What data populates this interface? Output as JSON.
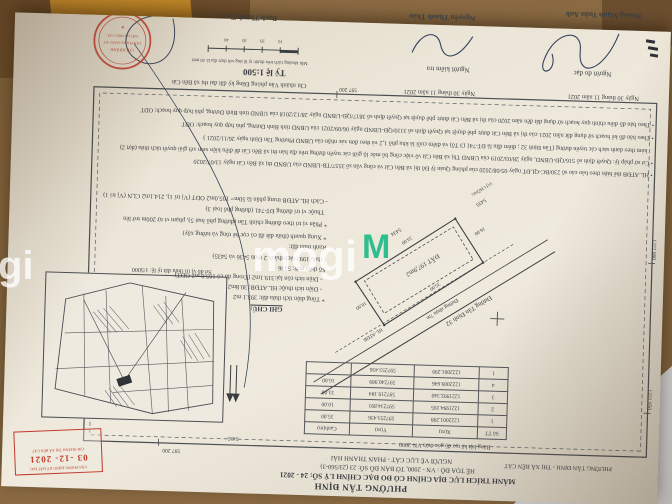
{
  "photo": {
    "background_color": "#8a6a42",
    "watermark": {
      "text": "mogi",
      "m_icon": "M",
      "green": "#2fbf8f"
    }
  },
  "document": {
    "header": {
      "region_line": "PHƯỜNG TÂN ĐỊNH - THỊ XÃ BẾN CÁT",
      "ward": "PHƯỜNG TÂN ĐỊNH",
      "title": "MẢNH TRÍCH LỤC ĐỊA CHÍNH CÓ ĐO ĐẠC CHỈNH LÝ SỐ: 24 - 2021",
      "coord_system": "HỆ TỌA ĐỘ : VN - 2000, TỜ BẢN ĐỒ SỐ: 23 (23/560-3)",
      "drafter": "NGƯỜI VẼ LỤC CÁT - PHAN THANH HẢI"
    },
    "grid_labels": {
      "top": "597 200",
      "bottom": "597 200",
      "left_top": "1221 950",
      "left_mid": "1222 000",
      "parcel_ref": "5435"
    },
    "coord_table": {
      "title": "Bảng liệt kê tọa độ góc thửa VN-2000",
      "columns": [
        "Số TT",
        "X(m)",
        "Y(m)",
        "Cạnh(m)"
      ],
      "rows": [
        [
          "1",
          "1222001.299",
          "597253.436",
          "35.00"
        ],
        [
          "2",
          "1221994.195",
          "597234.891",
          "10.00"
        ],
        [
          "3",
          "1221992.340",
          "597219.184",
          "33.00"
        ],
        [
          "4",
          "1222009.646",
          "597240.989",
          "16.00"
        ],
        [
          "1",
          "1222001.299",
          "597253.436",
          ""
        ]
      ]
    },
    "sketch": {
      "road_name": "Đường Tân Định 32",
      "road_surface": "Đường nhựa 7m",
      "corridor": "HL-ATĐB",
      "parcel_area": "ĐẤT 197,9m2",
      "dim_long_top": "35.00",
      "dim_short_right": "10.00",
      "dim_long_bottom": "33.00",
      "dim_short_left": "16.00",
      "neighbor_bottom": "5434",
      "neighbor_left": "5435",
      "neighbor_owner": "VỢ CHỒNG"
    },
    "inset": {
      "caption": "Sơ đồ vị trí thửa đất tỷ lệ: 1/5000"
    },
    "date_stamp": {
      "line1": "VĂN PHÒNG ĐĂNG KÝ ĐẤT ĐAI",
      "date": "03 -12- 2021",
      "line2": "CHI NHÁNH THỊ XÃ BẾN CÁT"
    },
    "notes": {
      "heading": "GHI CHÚ:",
      "lines": [
        "* Tổng diện tích thửa đất: 393.1 m2",
        "- Diện tích thuộc HL.ATĐB: 30.8m2",
        "- Diện tích còn lại:319.1m2 (Trong đó có 105.0 m2 ODT)",
        "Số thửa mới: 5436",
        "( thửa 1993 tách thành 2 thửa 5436 và 5435)",
        "Ranh thửa đất:",
        "* Xung quanh (thửa đất đã có cọc bê tông và tường xây)",
        "* Phần vị trí theo đường chính Tân (đường phố loại 5), phạm vi từ 200m trở lên",
        "Thuộc vị trí đường ĐT-741 (đường phố loại 3)",
        "- Cách HL.ATĐB trung phân là 50m= 105.0m2 ODT (Vị trí 1), 214.1m2 CLN (Vị trí 1)"
      ]
    },
    "bullets": [
      "• HL.ATĐB thể hiện theo báo cáo số 230/BC-QLĐT ngày 05/08/2020 của phòng Quản lý Đô thị xã Bến Cát và công văn số 3557/TB-UBND của UBND thị xã Bến Cát ngày 13/07/2020",
      "• Cơ sở pháp lý: Quyết định số 516/QĐ-UBND, ngày 28/03/2019 của UBND Thị xã Bến Cát về việc công bố mốc lộ giới các tuyến đường trên địa bàn thị xã Bến Cát để điều kiện xem xét giải quyết tách thửa (đợt 2)",
      "kèm theo danh sách các tuyến đường (Tân Định 32 ; điểm đầu là ĐT-741 (3 Tổ) và điểm cuối là khu phố 1,2 và theo đơn xác nhận của UBND Phường Tân Định ngày 26/11/2021 )",
      "• Theo bản đồ kế hoạch sử dụng đất năm 2021 của thị xã Bến Cát được phê duyệt tại Quyết định số 3110/QĐ-UBND ngày 06/09/2021 của UBND tỉnh Bình Dương, phù hợp quy hoạch: ODT",
      "• Theo bản đồ điều chỉnh quy hoạch sử dụng đất đến năm 2020 của thị xã Bến Cát được phê duyệt tại Quyết định số 3817/QĐ-UBND ngày 28/12/2018 của UBND tỉnh Bình Dương, phù hợp quy hoạch: ODT"
    ],
    "scale_block": {
      "office": "Chi nhánh Văn phòng Đăng ký đất đai thị xã Bến Cát",
      "label": "Tỷ lệ 1:500",
      "caption": "Mỗi khoảng cách trên thước tỷ lệ ứng với thực địa là 10 mét",
      "ticks": [
        "10",
        "20",
        "30",
        "40"
      ]
    },
    "signatures": {
      "col1": {
        "date": "Ngày 30 tháng 11 năm 2021",
        "role": "Người đo đạc",
        "name": "Hoàng Mạnh Tuấn Anh"
      },
      "col2": {
        "date": "Ngày 30 tháng 11 năm 2021",
        "role": "Người kiểm tra",
        "name": "Nguyễn Thanh Thảo"
      },
      "col3": {
        "name": "Bạch Thanh Trọng"
      }
    },
    "round_stamp": {
      "line1": "CHI NHÁNH",
      "line2": "VĂN PHÒNG ĐĂNG KÝ",
      "line3": "ĐẤT ĐAI BẾN CÁT",
      "star": "✶"
    }
  }
}
